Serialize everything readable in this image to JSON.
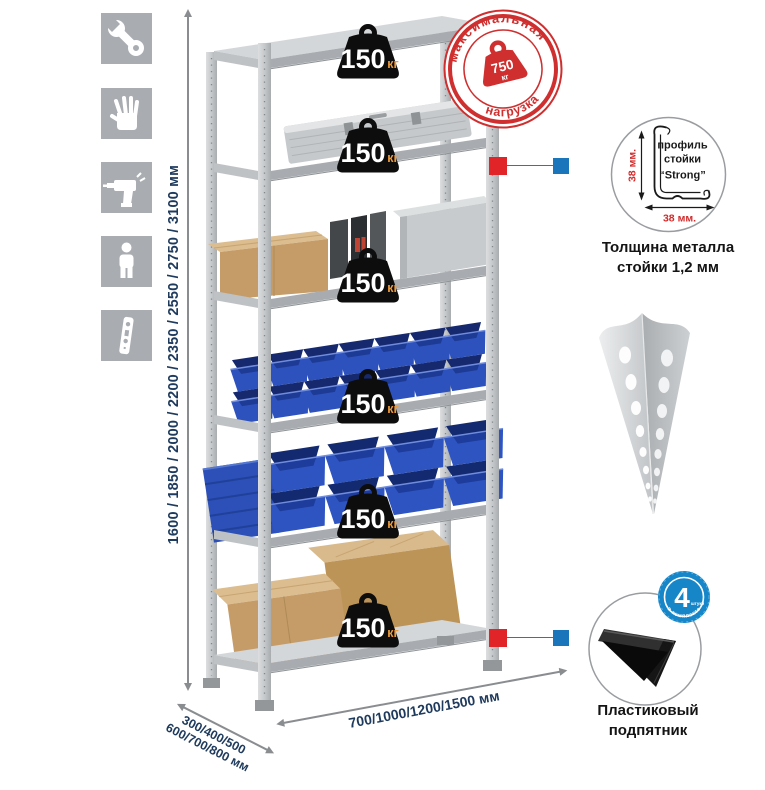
{
  "sidebar": {
    "icons": [
      {
        "name": "wrench-icon"
      },
      {
        "name": "gloves-icon"
      },
      {
        "name": "drill-icon"
      },
      {
        "name": "person-icon"
      },
      {
        "name": "rack-post-icon"
      }
    ]
  },
  "dimensions": {
    "height_label": "1600 / 1850 / 2000 / 2200 / 2350 / 2550 / 2750 / 3100 мм",
    "depth_line1": "300/400/500",
    "depth_line2": "600/700/800 мм",
    "width_label": "700/1000/1200/1500 мм"
  },
  "shelf_badges": [
    {
      "value": "150",
      "unit": "кг"
    },
    {
      "value": "150",
      "unit": "кг"
    },
    {
      "value": "150",
      "unit": "кг"
    },
    {
      "value": "150",
      "unit": "кг"
    },
    {
      "value": "150",
      "unit": "кг"
    },
    {
      "value": "150",
      "unit": "кг"
    }
  ],
  "stamp": {
    "arc_top": "максимальная",
    "arc_bottom": "нагрузка",
    "weight_value": "750",
    "weight_unit": "кг"
  },
  "profile_detail": {
    "label_line1": "профиль",
    "label_line2": "стойки",
    "label_line3": "“Strong”",
    "vertical_dim": "38 мм.",
    "horizontal_dim": "38 мм.",
    "caption_line1": "Толщина металла",
    "caption_line2": "стойки 1,2 мм"
  },
  "foot_detail": {
    "badge_number": "4",
    "badge_small_text": "штуки",
    "badge_arc_text": "в комплекте",
    "caption_line1": "Пластиковый",
    "caption_line2": "подпятник"
  },
  "colors": {
    "accent_red": "#cf2f2f",
    "accent_blue": "#1b75bb",
    "connector_red": "#e02428",
    "navy_text": "#1e3a5c",
    "badge_unit_orange": "#ef9b3a"
  }
}
